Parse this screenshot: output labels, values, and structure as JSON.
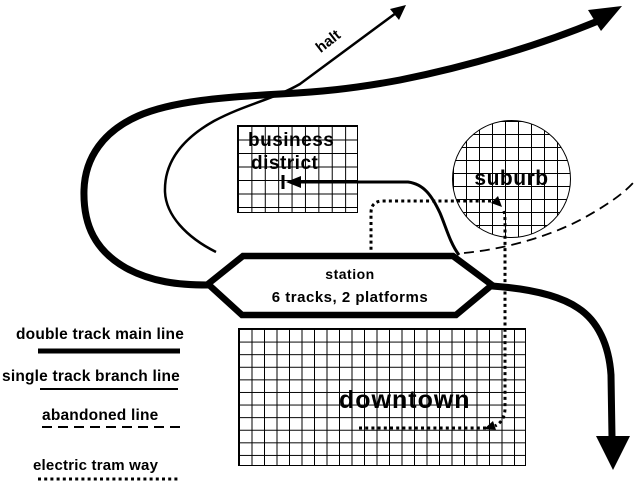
{
  "zones": {
    "business_district": {
      "line1": "business",
      "line2": "district"
    },
    "suburb": {
      "label": "suburb"
    },
    "downtown": {
      "label": "downtown"
    },
    "station": {
      "title": "station",
      "subtitle": "6 tracks, 2 platforms"
    },
    "halt": {
      "label": "halt"
    }
  },
  "legend": {
    "items": [
      {
        "label": "double track main line",
        "style": "thick-solid"
      },
      {
        "label": "single track branch line",
        "style": "thin-solid"
      },
      {
        "label": "abandoned line",
        "style": "dashed"
      },
      {
        "label": "electric tram way",
        "style": "dotted"
      }
    ]
  },
  "colors": {
    "ink": "#000000",
    "background": "#ffffff"
  }
}
